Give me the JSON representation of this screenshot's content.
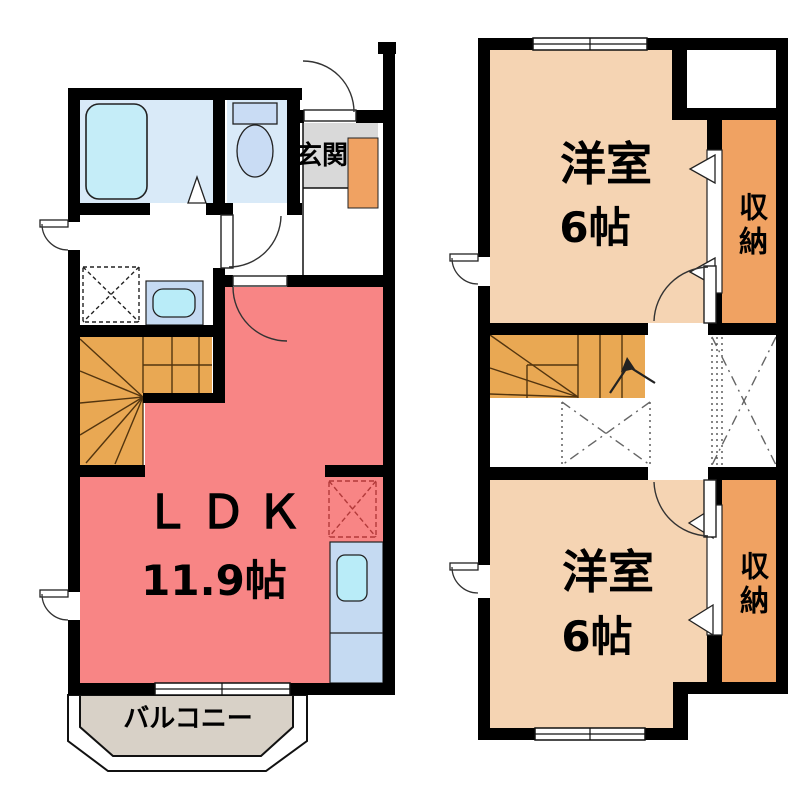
{
  "colors": {
    "wall": "#000000",
    "ldk": "#f88585",
    "room": "#f5d4b3",
    "stairs": "#e9a853",
    "storage": "#f0a262",
    "cabinet": "#f0a262",
    "genkan": "#d9d9d9",
    "balcony": "#d8d1c7",
    "bath_floor": "#d9eaf8",
    "tub": "#c5edf8",
    "fixture": "#c9dcf4",
    "counter": "#c5daf2",
    "sink": "#b9ecf8"
  },
  "floor1": {
    "genkan_label": "玄関",
    "ldk_label": "ＬＤＫ",
    "ldk_size": "11.9帖",
    "balcony_label": "バルコニー"
  },
  "floor2": {
    "room_top_label": "洋室",
    "room_top_size": "6帖",
    "room_bottom_label": "洋室",
    "room_bottom_size": "6帖",
    "storage_top_label": "収納",
    "storage_bottom_label": "収納"
  }
}
